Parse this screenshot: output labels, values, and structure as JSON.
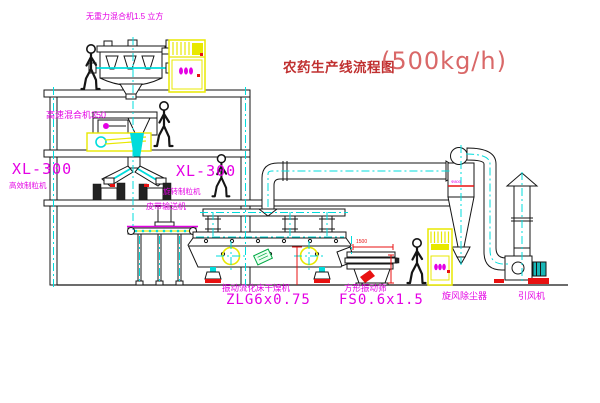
{
  "title": {
    "text": "农药生产线流程图",
    "capacity": "(500kg/h)"
  },
  "labels": {
    "gravityless_mixer": "无重力混合机1.5 立方",
    "high_speed_mixer": "高速混合机350",
    "granulator_left_model": "XL-300",
    "granulator_left_name": "高效制粒机",
    "granulator_right_model": "XL-300",
    "granulator_right_name": "旋转制粒机",
    "belt_conveyor": "皮带输送机",
    "fluid_bed_dryer_name": "振动流化床干燥机",
    "fluid_bed_dryer_model": "ZLG6x0.75",
    "vibrating_sieve_name": "方形振动筛",
    "vibrating_sieve_model": "FS0.6x1.5",
    "cyclone_dust_collector": "旋风除尘器",
    "induced_draft_fan": "引风机"
  },
  "dimensions": {
    "sieve_width": "1500",
    "cyclone_diameter": "Φ800"
  },
  "colors": {
    "background": "#ffffff",
    "line_black": "#151515",
    "centerline_cyan": "#00dcdc",
    "label_magenta": "#e400e4",
    "title_red": "#c03030",
    "capacity_red": "#d96868",
    "cabinet_yellow": "#e8e800",
    "dimension_red": "#e81111",
    "tag_green": "#00a844"
  }
}
